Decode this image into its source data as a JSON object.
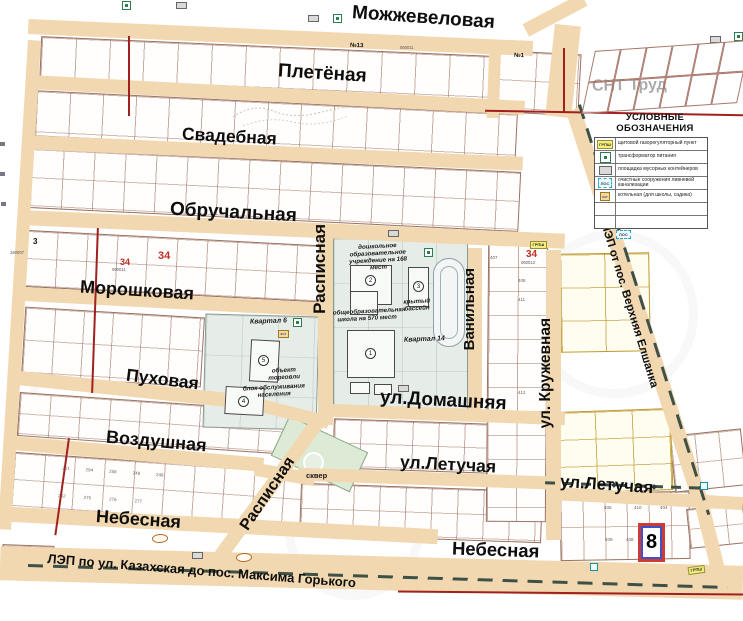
{
  "streets": {
    "mozhzhevelovaya": "Можжевеловая",
    "pletyonaya": "Плетёная",
    "svadebnaya": "Свадебная",
    "obruchalnaya": "Обручальная",
    "moroshkovaya": "Морошковая",
    "pukhovaya": "Пуховая",
    "vozdushnaya": "Воздушная",
    "nebesnaya": "Небесная",
    "raspisnaya": "Расписная",
    "vanilnaya": "Ванильная",
    "kruzhevnaya": "ул. Кружевная",
    "domashnyaya": "ул.Домашняя",
    "letuchaya": "ул.Летучая"
  },
  "areas": {
    "snt_trud": "СНТ Труд",
    "kvartal_6": "Квартал 6",
    "kvartal_14": "Квартал 14",
    "skver": "сквер",
    "kindergarten": "дошкольное образовательное учреждение на 168 мест",
    "school": "общеобразовательная школа на 570 мест",
    "pool": "крытый бассейн",
    "trade_object": "объект торговли",
    "service_block": "блок обслуживания населения"
  },
  "power_lines": {
    "bottom": "ЛЭП по ул. Казахская до пос. Максима Горького",
    "right": "ЛЭП от пос. Верхняя Елшанка"
  },
  "legend": {
    "title": "УСЛОВНЫЕ ОБОЗНАЧЕНИЯ",
    "items": [
      {
        "symbol": "ГРПШ",
        "label": "щитовой газорегуляторный пункт"
      },
      {
        "symbol": "",
        "label": "трансформатор питания"
      },
      {
        "symbol": "",
        "label": "площадка мусорных контейнеров"
      },
      {
        "symbol": "ЛОС",
        "label": "очистные сооружения ливневой канализации"
      },
      {
        "symbol": "кот",
        "label": "котельная (для школы, садика)"
      }
    ]
  },
  "cadastral": {
    "zone": "3",
    "zone_code": "160007",
    "quarter_left": "34",
    "quarter_left_code": "060011",
    "quarter_right": "34",
    "quarter_right_code": "060013",
    "strip_code": "060011",
    "plot_13": "№13",
    "plot_1": "№1"
  },
  "marker": {
    "selected_plot": "8"
  },
  "buildings": {
    "school_num": "1",
    "kindergarten_num": "2",
    "pool_num": "3",
    "service_num": "4",
    "trade_num": "5"
  },
  "plot_numbers": {
    "right_column": [
      "407",
      "408",
      "411",
      "412"
    ],
    "near_marker": [
      "405",
      "410",
      "404",
      "409",
      "408"
    ],
    "bottom_left": [
      "261",
      "294",
      "258",
      "249",
      "248",
      "262",
      "275",
      "276",
      "277"
    ]
  },
  "icons": {
    "grpsh": "ГРПШ",
    "los": "ЛОС",
    "kot": "кот"
  },
  "colors": {
    "road": "#f2d8b0",
    "plot_line": "#9a7261",
    "yellow_plot_line": "#c09a30",
    "red_utility_line": "#a02020",
    "power_line_dash": "#3f5046",
    "marker_red": "#cf3a34",
    "marker_blue": "#3c52c8",
    "district_red": "#c03028",
    "green_area": "#dcead6",
    "quarter_area": "#e6ede9"
  }
}
